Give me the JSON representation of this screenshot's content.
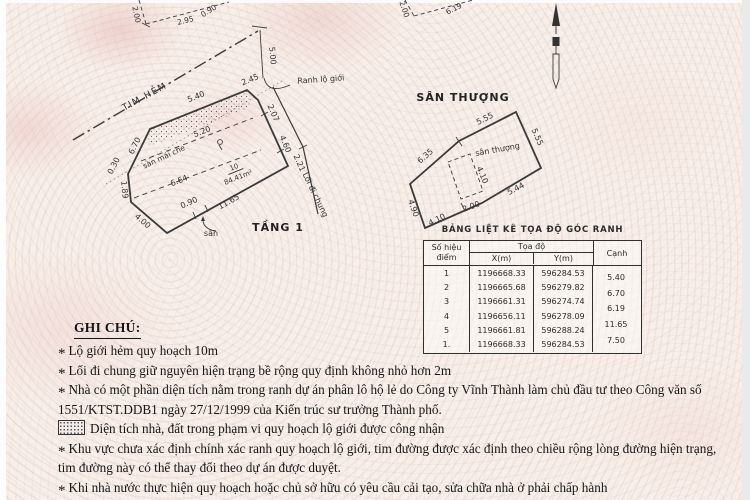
{
  "colors": {
    "paper": "#f7efe9",
    "pattern_pink": "#e7c6c3",
    "ink": "#3a3a3a"
  },
  "floor1": {
    "title": "TẦNG 1",
    "tim_hem": "TIM HẺM",
    "ranh_lo_gioi": "Ranh lộ giới",
    "loi_di_chung": "Lối đi chung",
    "san_mai_che": "sàn mái che",
    "san": "sân",
    "lot_no": "10",
    "area": "84.41m²",
    "setback": "5.00",
    "dims": {
      "top": "5.40",
      "top_right": "2.45",
      "right_a": "2.07",
      "right_b": "4.60",
      "path_w": "2.21",
      "bottom": "11.65",
      "bottom_left": "4.00",
      "left_a": "1.89",
      "left_b": "0.30",
      "upper_left": "6.70",
      "inner_a": "5.20",
      "inner_b": "6.64",
      "notch": "0.90"
    }
  },
  "fragment_left": {
    "dims": {
      "a": "2.00",
      "b": "2.95",
      "c": "0.90"
    }
  },
  "fragment_right": {
    "dims": {
      "a": "2.00",
      "b": "6.19"
    }
  },
  "roof": {
    "title": "SÂN THƯỢNG",
    "inner_label": "sân thượng",
    "dims": {
      "top": "5.55",
      "right": "5.55",
      "upper_left": "6.35",
      "lower_left": "4.90",
      "bottom": "4.10",
      "lower_right": "5.44",
      "void_h": "4.10",
      "void_w": "2.00"
    }
  },
  "table": {
    "title": "BẢNG LIỆT KÊ TỌA ĐỘ GÓC RANH",
    "head": {
      "point_1": "Số hiệu",
      "point_2": "điểm",
      "coords": "Tọa độ",
      "x": "X(m)",
      "y": "Y(m)",
      "edge": "Cạnh"
    },
    "rows": [
      {
        "no": "1",
        "x": "1196668.33",
        "y": "596284.53"
      },
      {
        "no": "2",
        "x": "1196665.68",
        "y": "596279.82"
      },
      {
        "no": "3",
        "x": "1196661.31",
        "y": "596274.74"
      },
      {
        "no": "4",
        "x": "1196656.11",
        "y": "596278.09"
      },
      {
        "no": "5",
        "x": "1196661.81",
        "y": "596288.24"
      },
      {
        "no": "1.",
        "x": "1196668.33",
        "y": "596284.53"
      }
    ],
    "edges": [
      "5.40",
      "6.70",
      "6.19",
      "11.65",
      "7.50"
    ]
  },
  "notes": {
    "heading": "GHI CHÚ:",
    "bullet": "*",
    "items": [
      {
        "text": "Lộ giới hẻm quy hoạch 10m"
      },
      {
        "text": "Lối đi chung giữ nguyên hiện trạng bề rộng quy định không nhỏ hơn 2m"
      },
      {
        "text": "Nhà có một phần diện tích nằm trong ranh dự án phân lô hộ lẻ do Công ty Vĩnh Thành làm chủ đầu tư theo Công văn số 1551/KTST.DDB1 ngày 27/12/1999 của Kiến trúc sư trưởng Thành phố."
      },
      {
        "text": "Diện tích nhà, đất trong phạm vi quy hoạch lộ giới được công nhận"
      },
      {
        "text": "Khu vực chưa xác định chính xác ranh quy hoạch lộ giới, tim đường được xác định theo chiều rộng lòng đường hiện trạng, tim đường này có thể thay đổi theo dự án được duyệt."
      },
      {
        "text": "Khi nhà nước thực hiện quy hoạch hoặc chủ sở hữu có yêu cầu cải tạo, sửa chữa nhà ở phải chấp hành"
      }
    ]
  }
}
